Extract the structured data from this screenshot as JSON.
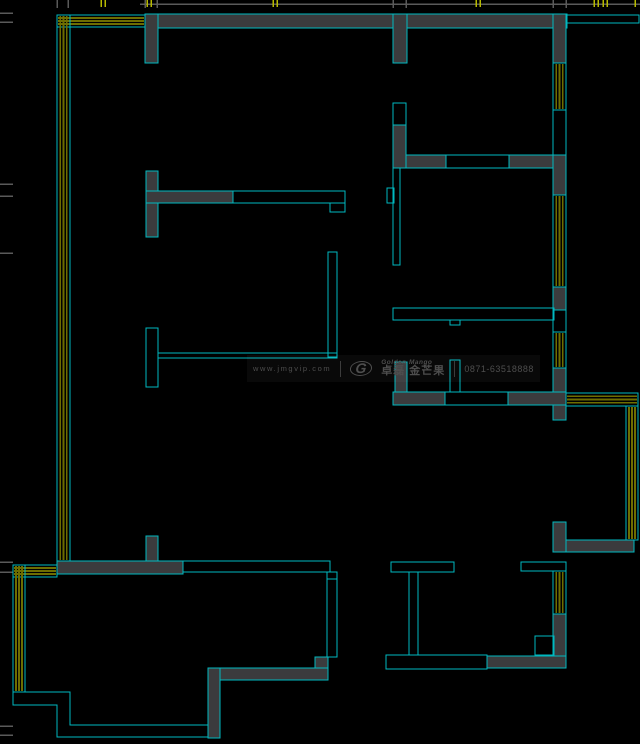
{
  "canvas": {
    "width": 640,
    "height": 744,
    "background": "#000000"
  },
  "palette": {
    "cyan": "#00b9c0",
    "wall_gray": "#3b3b3d",
    "olive": "#6d6d00",
    "tick_gray": "#5a5a5a",
    "tick_yellow": "#b7ba00",
    "watermark_text": "#4e4e4e"
  },
  "watermark": {
    "website": "www.jmgvip.com",
    "logo_glyph": "G",
    "brand_en": "Golden Mango",
    "brand_cn": "卓磊 金芒果",
    "phone": "0871-63518888"
  },
  "plan": {
    "top_line": {
      "x1": 140,
      "y1": 4,
      "x2": 640,
      "y2": 4
    },
    "top_ticks": {
      "gray_x": [
        57,
        68,
        145,
        157,
        393,
        406,
        553,
        566
      ],
      "yellow_x": [
        101,
        105,
        147,
        151,
        273,
        277,
        476,
        480,
        594,
        598,
        603,
        607,
        635
      ]
    },
    "left_ticks": {
      "gray_y": [
        13,
        22,
        184,
        196,
        253,
        562,
        572,
        726,
        735
      ]
    },
    "window_bands": [
      {
        "name": "window-top-left-h",
        "x": 57,
        "y": 15,
        "w": 88,
        "h": 12,
        "orient": "h"
      },
      {
        "name": "window-left-v",
        "x": 57,
        "y": 15,
        "w": 13,
        "h": 546,
        "orient": "v"
      },
      {
        "name": "window-right-1",
        "x": 553,
        "y": 63,
        "w": 13,
        "h": 47,
        "orient": "v"
      },
      {
        "name": "window-right-2",
        "x": 553,
        "y": 195,
        "w": 13,
        "h": 92,
        "orient": "v"
      },
      {
        "name": "window-right-3",
        "x": 553,
        "y": 332,
        "w": 13,
        "h": 36,
        "orient": "v"
      },
      {
        "name": "window-mid-right-h",
        "x": 566,
        "y": 393,
        "w": 72,
        "h": 13,
        "orient": "h"
      },
      {
        "name": "window-mid-right-v",
        "x": 626,
        "y": 406,
        "w": 12,
        "h": 134,
        "orient": "v"
      },
      {
        "name": "window-lower-right",
        "x": 553,
        "y": 571,
        "w": 13,
        "h": 43,
        "orient": "v"
      },
      {
        "name": "window-bottom-left-h",
        "x": 13,
        "y": 565,
        "w": 44,
        "h": 12,
        "orient": "h"
      },
      {
        "name": "window-bottom-left-v",
        "x": 13,
        "y": 565,
        "w": 12,
        "h": 127,
        "orient": "v"
      }
    ],
    "wall_rects": [
      {
        "name": "top-wall",
        "x": 145,
        "y": 14,
        "w": 422,
        "h": 14
      },
      {
        "name": "top-wall-stub-left",
        "x": 145,
        "y": 14,
        "w": 13,
        "h": 49
      },
      {
        "name": "top-wall-stub-mid",
        "x": 393,
        "y": 14,
        "w": 14,
        "h": 49
      },
      {
        "name": "right-wall-top-corner",
        "x": 553,
        "y": 14,
        "w": 13,
        "h": 49
      },
      {
        "name": "right-wall-seg-1",
        "x": 553,
        "y": 155,
        "w": 13,
        "h": 40
      },
      {
        "name": "right-wall-seg-2",
        "x": 553,
        "y": 287,
        "w": 13,
        "h": 23
      },
      {
        "name": "right-wall-seg-3",
        "x": 553,
        "y": 368,
        "w": 13,
        "h": 52
      },
      {
        "name": "room-divider-left",
        "x": 394,
        "y": 155,
        "w": 52,
        "h": 13
      },
      {
        "name": "room-divider-right",
        "x": 509,
        "y": 155,
        "w": 44,
        "h": 13
      },
      {
        "name": "room-divider-vert",
        "x": 393,
        "y": 125,
        "w": 13,
        "h": 43
      },
      {
        "name": "t-wall-vert",
        "x": 146,
        "y": 171,
        "w": 12,
        "h": 66
      },
      {
        "name": "t-wall-horiz",
        "x": 146,
        "y": 191,
        "w": 87,
        "h": 12
      },
      {
        "name": "bath-stub",
        "x": 395,
        "y": 362,
        "w": 12,
        "h": 30
      },
      {
        "name": "bath-wall-left",
        "x": 393,
        "y": 392,
        "w": 52,
        "h": 13
      },
      {
        "name": "bath-wall-right",
        "x": 508,
        "y": 392,
        "w": 58,
        "h": 13
      },
      {
        "name": "right-l-vert",
        "x": 553,
        "y": 522,
        "w": 13,
        "h": 30
      },
      {
        "name": "right-l-horiz",
        "x": 566,
        "y": 540,
        "w": 68,
        "h": 12
      },
      {
        "name": "lower-right-wall",
        "x": 553,
        "y": 614,
        "w": 13,
        "h": 54
      },
      {
        "name": "bottom-bar-right",
        "x": 487,
        "y": 656,
        "w": 79,
        "h": 12
      },
      {
        "name": "lower-left-wall",
        "x": 57,
        "y": 561,
        "w": 126,
        "h": 13
      },
      {
        "name": "lower-left-stub",
        "x": 146,
        "y": 536,
        "w": 12,
        "h": 25
      },
      {
        "name": "bl-step-block",
        "x": 315,
        "y": 657,
        "w": 13,
        "h": 11
      },
      {
        "name": "bl-bottom-bar",
        "x": 208,
        "y": 668,
        "w": 120,
        "h": 12
      },
      {
        "name": "bl-vert-bar",
        "x": 208,
        "y": 668,
        "w": 12,
        "h": 70
      }
    ],
    "outline_rects": [
      {
        "name": "top-wall-ext",
        "x": 567,
        "y": 15,
        "w": 72,
        "h": 8
      },
      {
        "name": "right-wall-open-1",
        "x": 553,
        "y": 110,
        "w": 13,
        "h": 45
      },
      {
        "name": "right-wall-open-2",
        "x": 553,
        "y": 310,
        "w": 13,
        "h": 22
      },
      {
        "name": "divider-open",
        "x": 446,
        "y": 155,
        "w": 63,
        "h": 13
      },
      {
        "name": "vert-open-box",
        "x": 393,
        "y": 103,
        "w": 13,
        "h": 22
      },
      {
        "name": "thin-wall-vert",
        "x": 393,
        "y": 168,
        "w": 7,
        "h": 97
      },
      {
        "name": "wall-tab",
        "x": 387,
        "y": 188,
        "w": 7,
        "h": 15
      },
      {
        "name": "thin-wall-horiz",
        "x": 393,
        "y": 308,
        "w": 161,
        "h": 12
      },
      {
        "name": "thin-wall-tab",
        "x": 450,
        "y": 320,
        "w": 10,
        "h": 5
      },
      {
        "name": "t-wall-ext",
        "x": 233,
        "y": 191,
        "w": 112,
        "h": 12
      },
      {
        "name": "t-wall-end-notch",
        "x": 330,
        "y": 203,
        "w": 15,
        "h": 9
      },
      {
        "name": "l-wall-vert",
        "x": 328,
        "y": 252,
        "w": 9,
        "h": 105
      },
      {
        "name": "l-wall-horiz",
        "x": 158,
        "y": 353,
        "w": 179,
        "h": 5
      },
      {
        "name": "column-stub",
        "x": 146,
        "y": 328,
        "w": 12,
        "h": 59
      },
      {
        "name": "bath-open-mid",
        "x": 445,
        "y": 392,
        "w": 63,
        "h": 13
      },
      {
        "name": "bath-stub-open",
        "x": 450,
        "y": 360,
        "w": 10,
        "h": 32
      },
      {
        "name": "bl-window-line",
        "x": 183,
        "y": 561,
        "w": 147,
        "h": 11
      },
      {
        "name": "bl-step-down",
        "x": 327,
        "y": 572,
        "w": 10,
        "h": 7
      },
      {
        "name": "bl-thin-vert",
        "x": 327,
        "y": 579,
        "w": 10,
        "h": 78
      },
      {
        "name": "t-column-top",
        "x": 391,
        "y": 562,
        "w": 63,
        "h": 10
      },
      {
        "name": "t-column-stem",
        "x": 409,
        "y": 572,
        "w": 9,
        "h": 83
      },
      {
        "name": "bottom-bar-open",
        "x": 386,
        "y": 655,
        "w": 101,
        "h": 14
      },
      {
        "name": "lower-right-cap",
        "x": 521,
        "y": 562,
        "w": 45,
        "h": 9
      },
      {
        "name": "notch-square",
        "x": 535,
        "y": 636,
        "w": 19,
        "h": 19
      }
    ],
    "paths": [
      {
        "name": "bl-outline-outer",
        "d": "M13,692 L13,705 L57,705 L57,737 L208,737"
      },
      {
        "name": "bl-outline-inner",
        "d": "M25,692 L70,692 L70,725 L208,725"
      }
    ]
  }
}
